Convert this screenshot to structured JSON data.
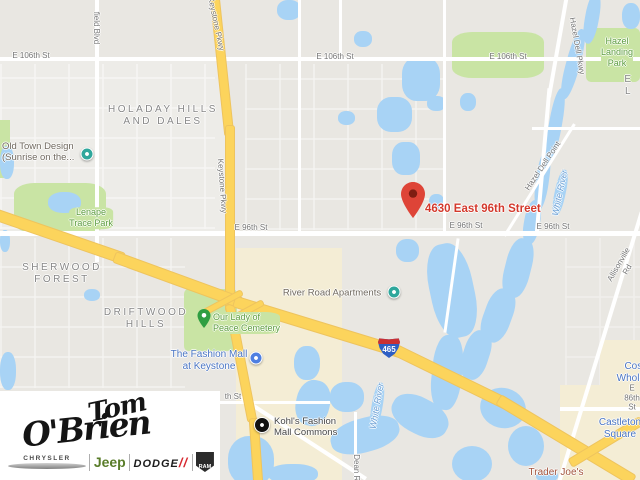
{
  "map": {
    "address_marker": {
      "label": "4630 East 96th Street",
      "color": "#d3392c"
    },
    "interstate_shield": {
      "number": "465"
    },
    "palette": {
      "background": "#e9e7e2",
      "water": "#a8d3f5",
      "park": "#c9e4a4",
      "commercial": "#f4edd5",
      "highway": "#fcd45c",
      "road": "#ffffff"
    },
    "labels": [
      {
        "text": "E 106th St",
        "x": 31,
        "y": 56,
        "cls": "road"
      },
      {
        "text": "E 106th St",
        "x": 335,
        "y": 57,
        "cls": "road"
      },
      {
        "text": "E 106th St",
        "x": 508,
        "y": 57,
        "cls": "road"
      },
      {
        "text": "field Blvd",
        "x": 96,
        "y": 28,
        "cls": "road",
        "rot": 90
      },
      {
        "text": "Keystone Pkwy",
        "x": 216,
        "y": 24,
        "cls": "road",
        "rot": 78
      },
      {
        "text": "Keystone Pkwy",
        "x": 222,
        "y": 186,
        "cls": "road",
        "rot": 86
      },
      {
        "text": "E 96th St",
        "x": 251,
        "y": 228,
        "cls": "road"
      },
      {
        "text": "E 96th St",
        "x": 466,
        "y": 226,
        "cls": "road"
      },
      {
        "text": "E 96th St",
        "x": 553,
        "y": 227,
        "cls": "road"
      },
      {
        "text": "Hazel Dell Pkwy",
        "x": 577,
        "y": 46,
        "cls": "road",
        "rot": 80
      },
      {
        "text": "Hazel Dell Point",
        "x": 543,
        "y": 166,
        "cls": "road",
        "rot": -56
      },
      {
        "text": "Allisonville Rd",
        "x": 623,
        "y": 267,
        "cls": "road",
        "rot": -60
      },
      {
        "text": "Dean Rd",
        "x": 356,
        "y": 470,
        "cls": "road",
        "rot": 90
      },
      {
        "text": "E 86th St",
        "x": 632,
        "y": 398,
        "cls": "road"
      },
      {
        "text": "th St",
        "x": 233,
        "y": 397,
        "cls": "road"
      },
      {
        "text": "HOLADAY HILLS\nAND DALES",
        "x": 163,
        "y": 116,
        "cls": "area"
      },
      {
        "text": "SHERWOOD\nFOREST",
        "x": 62,
        "y": 274,
        "cls": "area"
      },
      {
        "text": "DRIFTWOOD\nHILLS",
        "x": 146,
        "y": 319,
        "cls": "area"
      },
      {
        "text": "E L",
        "x": 629,
        "y": 86,
        "cls": "area"
      },
      {
        "text": "Hazel\nLanding Park",
        "x": 617,
        "y": 52,
        "cls": "park"
      },
      {
        "text": "Lenape\nTrace Park",
        "x": 91,
        "y": 218,
        "cls": "park"
      },
      {
        "text": "Our Lady of\nPeace Cemetery",
        "x": 213,
        "y": 312,
        "cls": "park",
        "align": "left"
      },
      {
        "text": "White River",
        "x": 560,
        "y": 193,
        "cls": "water",
        "rot": -78
      },
      {
        "text": "White River",
        "x": 377,
        "y": 406,
        "cls": "water",
        "rot": -80
      },
      {
        "text": "Old Town Design\n(Sunrise on the...",
        "x": 2,
        "y": 141,
        "cls": "poigray",
        "align": "left"
      },
      {
        "text": "River Road Apartments",
        "x": 332,
        "y": 293,
        "cls": "poigray"
      },
      {
        "text": "The Fashion Mall\nat Keystone",
        "x": 209,
        "y": 361,
        "cls": "poiblue"
      },
      {
        "text": "Castleton Square",
        "x": 620,
        "y": 429,
        "cls": "poiblue"
      },
      {
        "text": "Costco Wholesale",
        "x": 640,
        "y": 373,
        "cls": "poiblue"
      },
      {
        "text": "Trader Joe's",
        "x": 556,
        "y": 473,
        "cls": "poired"
      },
      {
        "text": "Kohl's Fashion\nMall Commons",
        "x": 274,
        "y": 416,
        "cls": "poidark",
        "align": "left"
      }
    ],
    "pins": [
      {
        "type": "teal-circle",
        "x": 87,
        "y": 154,
        "name": "old-town-design-pin"
      },
      {
        "type": "teal-circle",
        "x": 394,
        "y": 292,
        "name": "river-road-apartments-pin"
      },
      {
        "type": "green-pin",
        "x": 204,
        "y": 333,
        "name": "cemetery-pin"
      },
      {
        "type": "blue-circle",
        "x": 256,
        "y": 358,
        "name": "fashion-mall-pin"
      },
      {
        "type": "black-circle",
        "x": 262,
        "y": 425,
        "name": "kohls-pin"
      }
    ]
  },
  "dealer_logo": {
    "name_line1": "Tom",
    "name_line2": "O'Brien",
    "dodge_slashes": "//",
    "brands": [
      {
        "label": "CHRYSLER"
      },
      {
        "label": "Jeep"
      },
      {
        "label": "DODGE"
      },
      {
        "label": "RAM"
      }
    ]
  }
}
